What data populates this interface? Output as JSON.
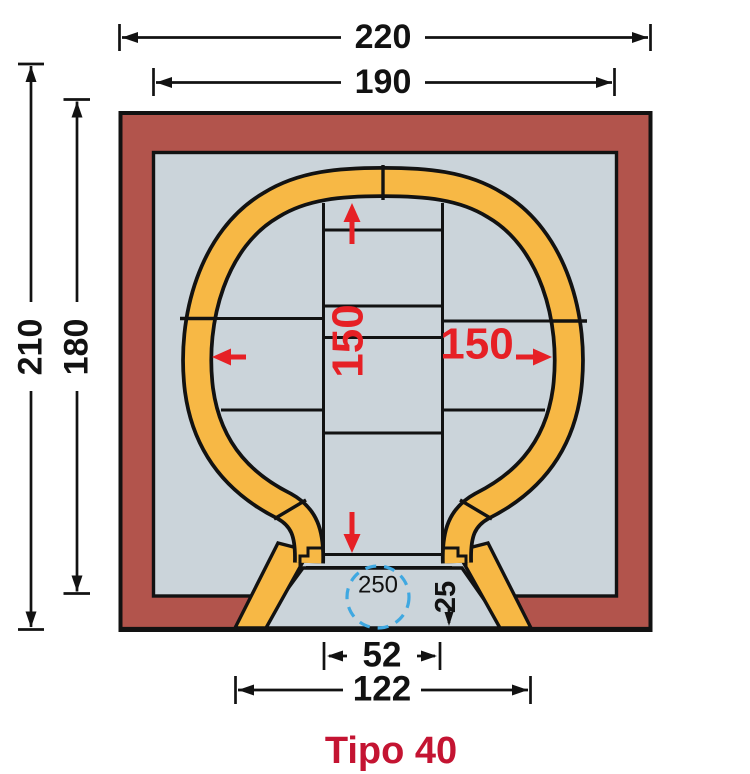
{
  "title": {
    "label": "Tipo 40"
  },
  "dims": {
    "total_width": "220",
    "inner_width": "190",
    "total_height": "210",
    "inner_height": "180",
    "dome_height": "150",
    "dome_width": "150",
    "flue_width": "52",
    "base_width": "122",
    "hearth_depth": "25",
    "hearth_diameter": "250"
  },
  "colors": {
    "wall_brown": "#b2544c",
    "interior_gray": "#cbd4da",
    "brick_orange": "#f7b845",
    "accent_red": "#e62025",
    "title_red": "#c41432",
    "guide_blue": "#3fa8e1",
    "outline_black": "#121212"
  }
}
